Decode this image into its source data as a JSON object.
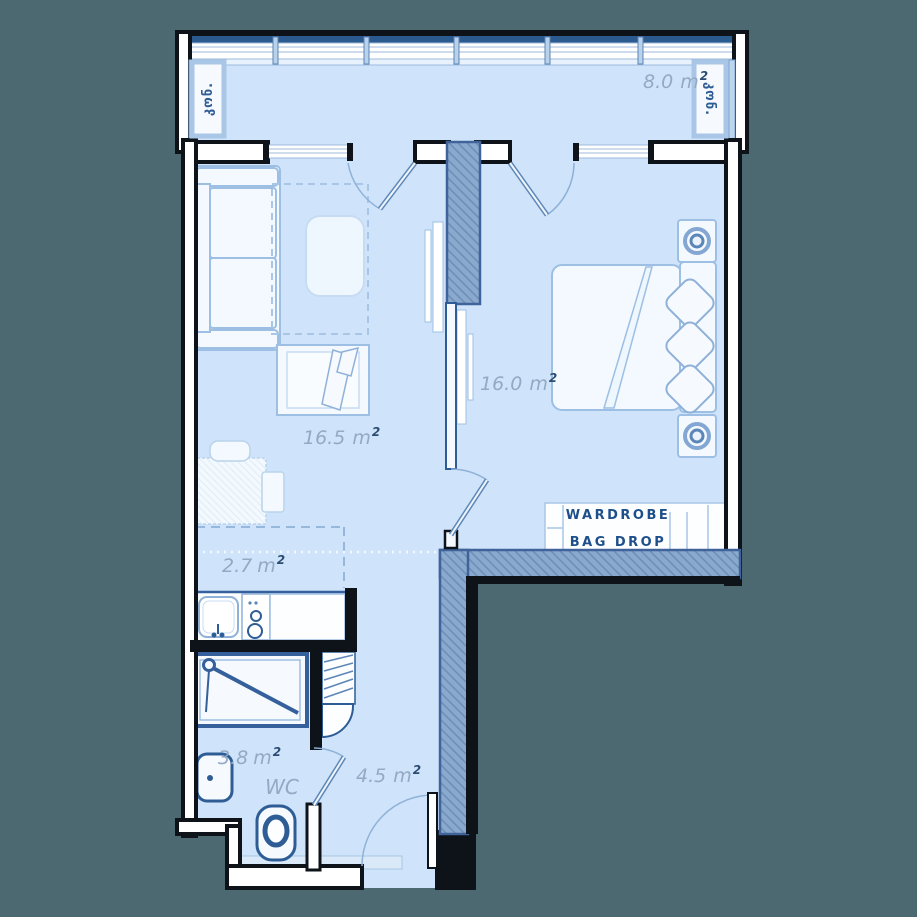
{
  "plan": {
    "type": "apartment-floor-plan",
    "colors": {
      "background": "#4C6871",
      "floor": "#CFE4FA",
      "wall_outline": "#0D1319",
      "hatched_wall": "#8BA9CD",
      "accent_navy": "#2E5D96",
      "area_label": "#93A9C4",
      "superscript": "#2B4D74",
      "closet_text": "#1D4F8A"
    }
  },
  "units": {
    "meter": "m",
    "superscript": "2"
  },
  "balcony": {
    "area_value": "8.0",
    "ac_left_label": "კონ.",
    "ac_right_label": "კონ."
  },
  "rooms": {
    "living_room": {
      "area_value": "16.5"
    },
    "bedroom": {
      "area_value": "16.0"
    },
    "kitchen": {
      "area_value": "2.7"
    },
    "bathroom": {
      "area_value": "3.8",
      "room_label": "WC"
    },
    "hallway": {
      "area_value": "4.5"
    }
  },
  "wardrobe": {
    "line1": "WARDROBE",
    "line2": "BAG DROP"
  }
}
